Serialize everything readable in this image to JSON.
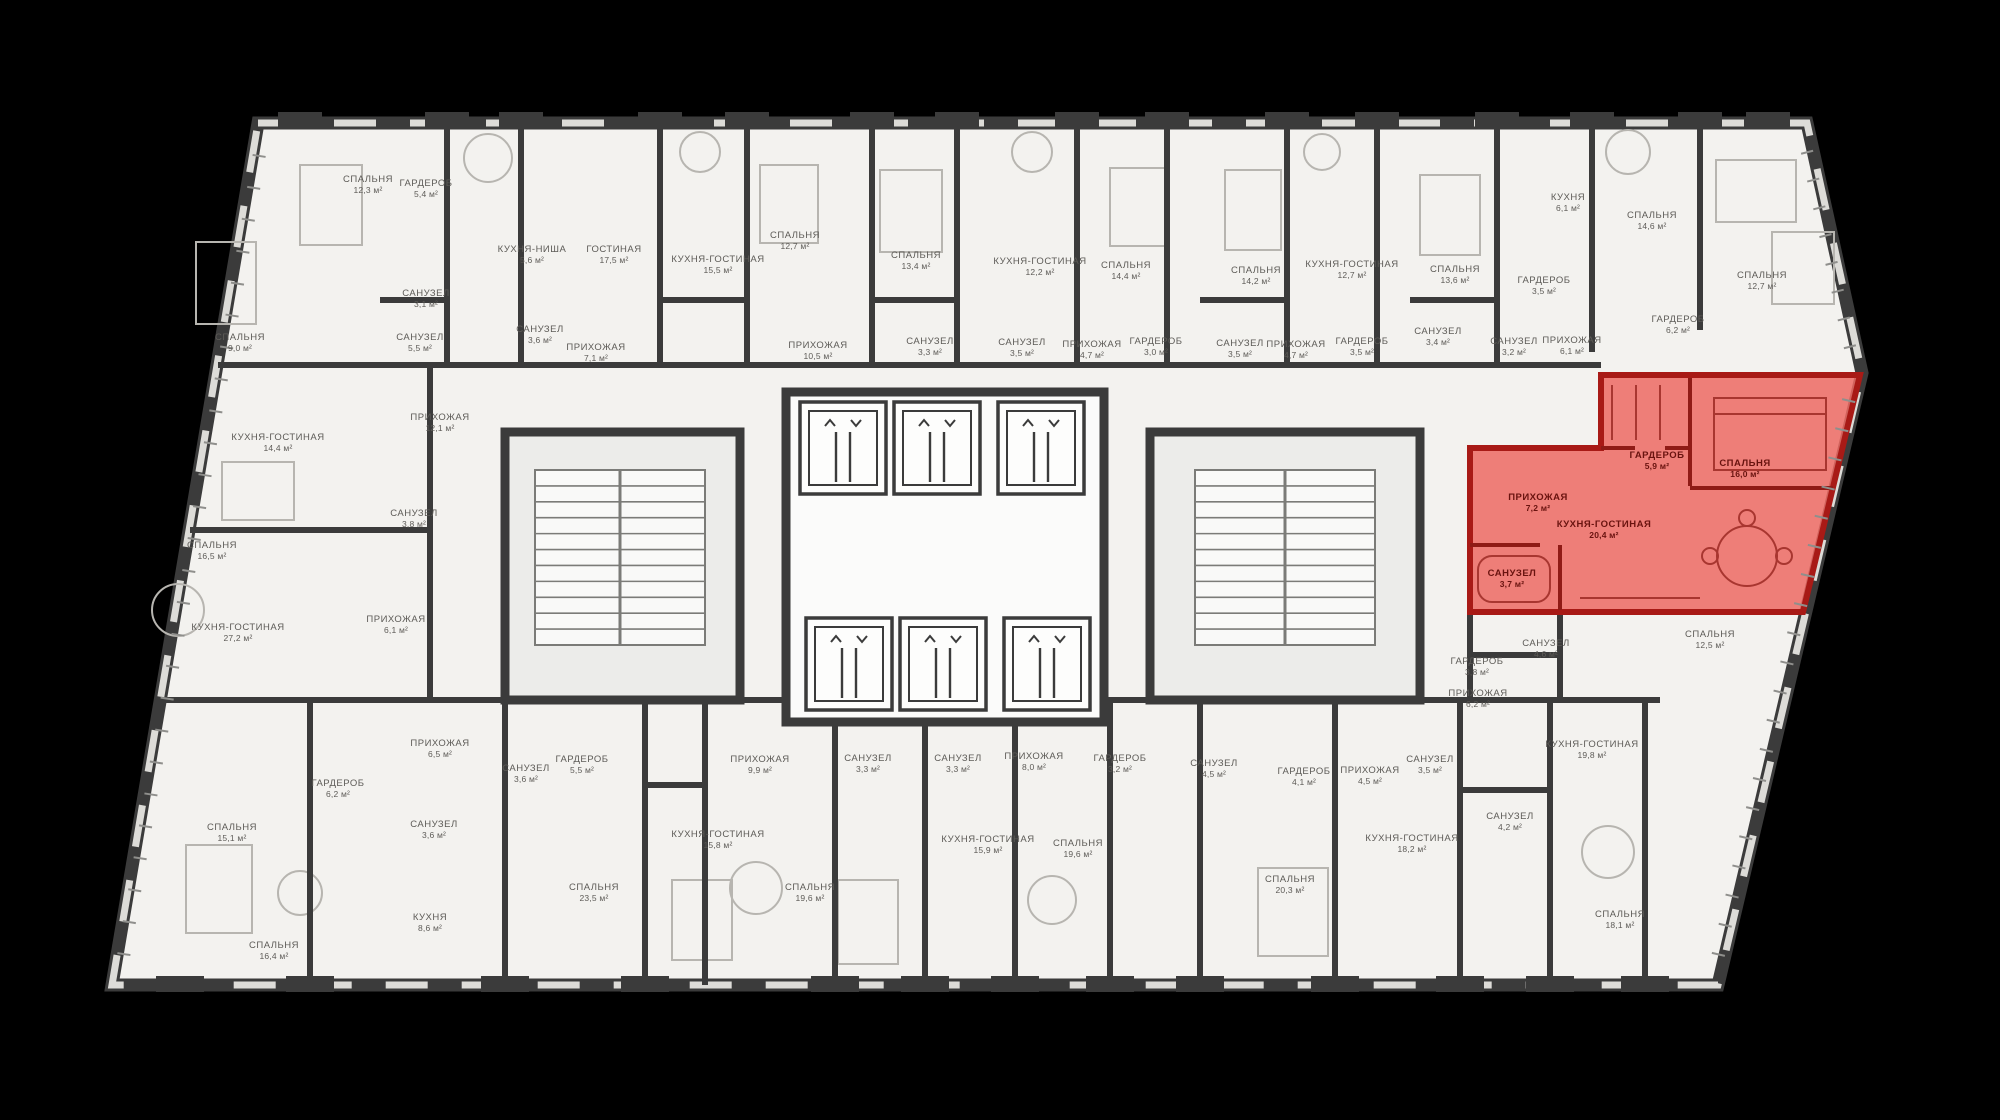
{
  "scene": {
    "background": "#000000",
    "floor_fill": "#f3f2ef",
    "wall_color": "#3b3b3b",
    "furniture_color": "#b7b5b0",
    "window_color": "#dddcd8",
    "highlight_fill": "#ec6a63",
    "highlight_stroke": "#a81a16",
    "highlight_wall": "#8f1b16",
    "label_color": "#5d5b57",
    "highlight_label_color": "#69130f",
    "area_unit": "м²"
  },
  "highlighted_apartment": {
    "rooms": [
      {
        "name": "ПРИХОЖАЯ",
        "area": "7,2 м²",
        "x": 1538,
        "y": 500
      },
      {
        "name": "ГАРДЕРОБ",
        "area": "5,9 м²",
        "x": 1657,
        "y": 458
      },
      {
        "name": "СПАЛЬНЯ",
        "area": "16,0 м²",
        "x": 1745,
        "y": 466
      },
      {
        "name": "КУХНЯ-ГОСТИНАЯ",
        "area": "20,4 м²",
        "x": 1604,
        "y": 527
      },
      {
        "name": "САНУЗЕЛ",
        "area": "3,7 м²",
        "x": 1512,
        "y": 576
      }
    ]
  },
  "rooms": [
    {
      "name": "СПАЛЬНЯ",
      "area": "12,3 м²",
      "x": 368,
      "y": 182
    },
    {
      "name": "ГАРДЕРОБ",
      "area": "5,4 м²",
      "x": 426,
      "y": 186
    },
    {
      "name": "КУХНЯ-НИША",
      "area": "5,6 м²",
      "x": 532,
      "y": 252
    },
    {
      "name": "ГОСТИНАЯ",
      "area": "17,5 м²",
      "x": 614,
      "y": 252
    },
    {
      "name": "СПАЛЬНЯ",
      "area": "9,0 м²",
      "x": 240,
      "y": 340
    },
    {
      "name": "САНУЗЕЛ",
      "area": "3,1 м²",
      "x": 426,
      "y": 296
    },
    {
      "name": "САНУЗЕЛ",
      "area": "5,5 м²",
      "x": 420,
      "y": 340
    },
    {
      "name": "САНУЗЕЛ",
      "area": "3,6 м²",
      "x": 540,
      "y": 332
    },
    {
      "name": "ПРИХОЖАЯ",
      "area": "7,1 м²",
      "x": 596,
      "y": 350
    },
    {
      "name": "КУХНЯ-ГОСТИНАЯ",
      "area": "15,5 м²",
      "x": 718,
      "y": 262
    },
    {
      "name": "СПАЛЬНЯ",
      "area": "12,7 м²",
      "x": 795,
      "y": 238
    },
    {
      "name": "ПРИХОЖАЯ",
      "area": "10,5 м²",
      "x": 818,
      "y": 348
    },
    {
      "name": "СПАЛЬНЯ",
      "area": "13,4 м²",
      "x": 916,
      "y": 258
    },
    {
      "name": "САНУЗЕЛ",
      "area": "3,3 м²",
      "x": 930,
      "y": 344
    },
    {
      "name": "КУХНЯ-ГОСТИНАЯ",
      "area": "12,2 м²",
      "x": 1040,
      "y": 264
    },
    {
      "name": "САНУЗЕЛ",
      "area": "3,5 м²",
      "x": 1022,
      "y": 345
    },
    {
      "name": "ПРИХОЖАЯ",
      "area": "4,7 м²",
      "x": 1092,
      "y": 347
    },
    {
      "name": "СПАЛЬНЯ",
      "area": "14,4 м²",
      "x": 1126,
      "y": 268
    },
    {
      "name": "ГАРДЕРОБ",
      "area": "3,0 м²",
      "x": 1156,
      "y": 344
    },
    {
      "name": "СПАЛЬНЯ",
      "area": "14,2 м²",
      "x": 1256,
      "y": 273
    },
    {
      "name": "САНУЗЕЛ",
      "area": "3,5 м²",
      "x": 1240,
      "y": 346
    },
    {
      "name": "ПРИХОЖАЯ",
      "area": "4,7 м²",
      "x": 1296,
      "y": 347
    },
    {
      "name": "КУХНЯ-ГОСТИНАЯ",
      "area": "12,7 м²",
      "x": 1352,
      "y": 267
    },
    {
      "name": "ГАРДЕРОБ",
      "area": "3,5 м²",
      "x": 1362,
      "y": 344
    },
    {
      "name": "СПАЛЬНЯ",
      "area": "13,6 м²",
      "x": 1455,
      "y": 272
    },
    {
      "name": "САНУЗЕЛ",
      "area": "3,4 м²",
      "x": 1438,
      "y": 334
    },
    {
      "name": "САНУЗЕЛ",
      "area": "3,2 м²",
      "x": 1514,
      "y": 344
    },
    {
      "name": "ПРИХОЖАЯ",
      "area": "6,1 м²",
      "x": 1572,
      "y": 343
    },
    {
      "name": "ГАРДЕРОБ",
      "area": "3,5 м²",
      "x": 1544,
      "y": 283
    },
    {
      "name": "КУХНЯ",
      "area": "6,1 м²",
      "x": 1568,
      "y": 200
    },
    {
      "name": "СПАЛЬНЯ",
      "area": "14,6 м²",
      "x": 1652,
      "y": 218
    },
    {
      "name": "СПАЛЬНЯ",
      "area": "12,7 м²",
      "x": 1762,
      "y": 278
    },
    {
      "name": "ГАРДЕРОБ",
      "area": "6,2 м²",
      "x": 1678,
      "y": 322
    },
    {
      "name": "КУХНЯ-ГОСТИНАЯ",
      "area": "14,4 м²",
      "x": 278,
      "y": 440
    },
    {
      "name": "ПРИХОЖАЯ",
      "area": "12,1 м²",
      "x": 440,
      "y": 420
    },
    {
      "name": "САНУЗЕЛ",
      "area": "3,8 м²",
      "x": 414,
      "y": 516
    },
    {
      "name": "СПАЛЬНЯ",
      "area": "16,5 м²",
      "x": 212,
      "y": 548
    },
    {
      "name": "ПРИХОЖАЯ",
      "area": "6,1 м²",
      "x": 396,
      "y": 622
    },
    {
      "name": "КУХНЯ-ГОСТИНАЯ",
      "area": "27,2 м²",
      "x": 238,
      "y": 630
    },
    {
      "name": "СПАЛЬНЯ",
      "area": "15,1 м²",
      "x": 232,
      "y": 830
    },
    {
      "name": "ГАРДЕРОБ",
      "area": "6,2 м²",
      "x": 338,
      "y": 786
    },
    {
      "name": "ПРИХОЖАЯ",
      "area": "6,5 м²",
      "x": 440,
      "y": 746
    },
    {
      "name": "САНУЗЕЛ",
      "area": "3,6 м²",
      "x": 434,
      "y": 827
    },
    {
      "name": "САНУЗЕЛ",
      "area": "3,6 м²",
      "x": 526,
      "y": 771
    },
    {
      "name": "ГАРДЕРОБ",
      "area": "5,5 м²",
      "x": 582,
      "y": 762
    },
    {
      "name": "СПАЛЬНЯ",
      "area": "16,4 м²",
      "x": 274,
      "y": 948
    },
    {
      "name": "КУХНЯ",
      "area": "8,6 м²",
      "x": 430,
      "y": 920
    },
    {
      "name": "СПАЛЬНЯ",
      "area": "23,5 м²",
      "x": 594,
      "y": 890
    },
    {
      "name": "ПРИХОЖАЯ",
      "area": "9,9 м²",
      "x": 760,
      "y": 762
    },
    {
      "name": "САНУЗЕЛ",
      "area": "3,3 м²",
      "x": 868,
      "y": 761
    },
    {
      "name": "САНУЗЕЛ",
      "area": "3,3 м²",
      "x": 958,
      "y": 761
    },
    {
      "name": "ПРИХОЖАЯ",
      "area": "8,0 м²",
      "x": 1034,
      "y": 759
    },
    {
      "name": "ГАРДЕРОБ",
      "area": "3,2 м²",
      "x": 1120,
      "y": 761
    },
    {
      "name": "КУХНЯ-ГОСТИНАЯ",
      "area": "15,8 м²",
      "x": 718,
      "y": 837
    },
    {
      "name": "СПАЛЬНЯ",
      "area": "19,6 м²",
      "x": 810,
      "y": 890
    },
    {
      "name": "КУХНЯ-ГОСТИНАЯ",
      "area": "15,9 м²",
      "x": 988,
      "y": 842
    },
    {
      "name": "СПАЛЬНЯ",
      "area": "19,6 м²",
      "x": 1078,
      "y": 846
    },
    {
      "name": "САНУЗЕЛ",
      "area": "4,5 м²",
      "x": 1214,
      "y": 766
    },
    {
      "name": "ГАРДЕРОБ",
      "area": "4,1 м²",
      "x": 1304,
      "y": 774
    },
    {
      "name": "ПРИХОЖАЯ",
      "area": "4,5 м²",
      "x": 1370,
      "y": 773
    },
    {
      "name": "САНУЗЕЛ",
      "area": "3,5 м²",
      "x": 1430,
      "y": 762
    },
    {
      "name": "КУХНЯ-ГОСТИНАЯ",
      "area": "18,2 м²",
      "x": 1412,
      "y": 841
    },
    {
      "name": "САНУЗЕЛ",
      "area": "4,2 м²",
      "x": 1510,
      "y": 819
    },
    {
      "name": "СПАЛЬНЯ",
      "area": "20,3 м²",
      "x": 1290,
      "y": 882
    },
    {
      "name": "ГАРДЕРОБ",
      "area": "3,8 м²",
      "x": 1477,
      "y": 664
    },
    {
      "name": "САНУЗЕЛ",
      "area": "4,6 м²",
      "x": 1546,
      "y": 646
    },
    {
      "name": "ПРИХОЖАЯ",
      "area": "6,2 м²",
      "x": 1478,
      "y": 696
    },
    {
      "name": "КУХНЯ-ГОСТИНАЯ",
      "area": "19,8 м²",
      "x": 1592,
      "y": 747
    },
    {
      "name": "СПАЛЬНЯ",
      "area": "12,5 м²",
      "x": 1710,
      "y": 637
    },
    {
      "name": "СПАЛЬНЯ",
      "area": "18,1 м²",
      "x": 1620,
      "y": 917
    }
  ]
}
